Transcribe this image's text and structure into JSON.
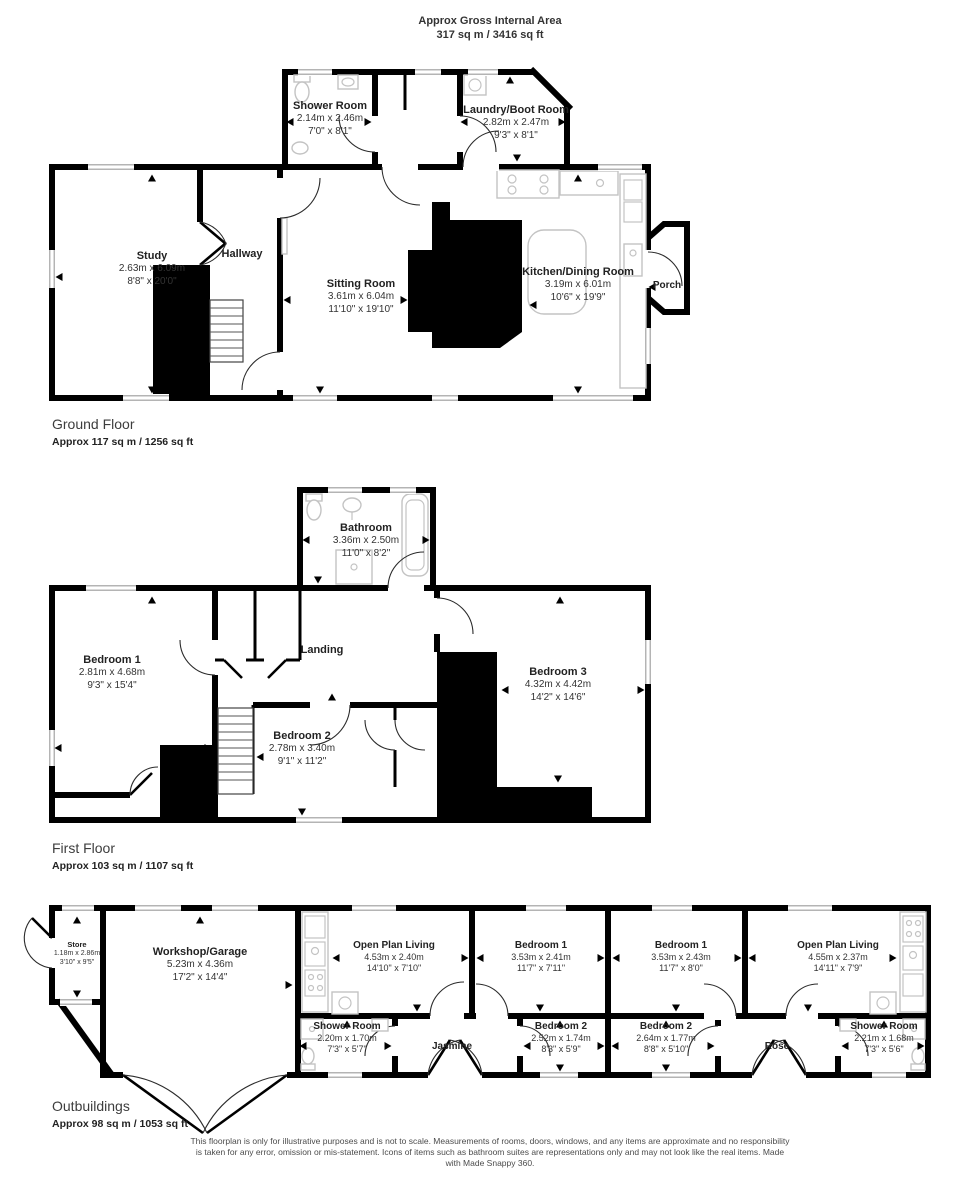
{
  "header": {
    "title": "Approx Gross Internal Area",
    "subtitle": "317 sq m / 3416 sq ft"
  },
  "ground_floor": {
    "title": "Ground Floor",
    "area": "Approx 117 sq m / 1256 sq ft",
    "rooms": {
      "shower_room": {
        "name": "Shower Room",
        "metric": "2.14m x 2.46m",
        "imperial": "7'0\" x 8'1\""
      },
      "laundry_boot_room": {
        "name": "Laundry/Boot Room",
        "metric": "2.82m x 2.47m",
        "imperial": "9'3\" x 8'1\""
      },
      "study": {
        "name": "Study",
        "metric": "2.63m x 6.09m",
        "imperial": "8'8\" x 20'0\""
      },
      "hallway": {
        "name": "Hallway"
      },
      "sitting_room": {
        "name": "Sitting Room",
        "metric": "3.61m x 6.04m",
        "imperial": "11'10\" x 19'10\""
      },
      "kitchen_dining_room": {
        "name": "Kitchen/Dining Room",
        "metric": "3.19m x 6.01m",
        "imperial": "10'6\" x 19'9\""
      },
      "porch": {
        "name": "Porch"
      }
    }
  },
  "first_floor": {
    "title": "First Floor",
    "area": "Approx 103 sq m / 1107 sq ft",
    "rooms": {
      "bathroom": {
        "name": "Bathroom",
        "metric": "3.36m x 2.50m",
        "imperial": "11'0\" x 8'2\""
      },
      "bedroom_1": {
        "name": "Bedroom 1",
        "metric": "2.81m x 4.68m",
        "imperial": "9'3\" x 15'4\""
      },
      "landing": {
        "name": "Landing"
      },
      "bedroom_2": {
        "name": "Bedroom 2",
        "metric": "2.78m x 3.40m",
        "imperial": "9'1\" x 11'2\""
      },
      "bedroom_3": {
        "name": "Bedroom 3",
        "metric": "4.32m x 4.42m",
        "imperial": "14'2\" x 14'6\""
      }
    }
  },
  "outbuildings": {
    "title": "Outbuildings",
    "area": "Approx 98 sq m / 1053 sq ft",
    "rooms": {
      "store": {
        "name": "Store",
        "metric": "1.18m x 2.86m",
        "imperial": "3'10\" x 9'5\""
      },
      "workshop_garage": {
        "name": "Workshop/Garage",
        "metric": "5.23m x 4.36m",
        "imperial": "17'2\" x 14'4\""
      },
      "jasmine_open_plan_living": {
        "name": "Open Plan Living",
        "metric": "4.53m x 2.40m",
        "imperial": "14'10\" x 7'10\""
      },
      "jasmine_bedroom_1": {
        "name": "Bedroom 1",
        "metric": "3.53m x 2.41m",
        "imperial": "11'7\" x 7'11\""
      },
      "jasmine_shower_room": {
        "name": "Shower Room",
        "metric": "2.20m x 1.70m",
        "imperial": "7'3\" x 5'7\""
      },
      "jasmine_bedroom_2": {
        "name": "Bedroom 2",
        "metric": "2.52m x 1.74m",
        "imperial": "8'3\" x 5'9\""
      },
      "jasmine": {
        "name": "Jasmine"
      },
      "rose_bedroom_1": {
        "name": "Bedroom 1",
        "metric": "3.53m x 2.43m",
        "imperial": "11'7\" x 8'0\""
      },
      "rose_open_plan_living": {
        "name": "Open Plan Living",
        "metric": "4.55m x 2.37m",
        "imperial": "14'11\" x 7'9\""
      },
      "rose_bedroom_2": {
        "name": "Bedroom 2",
        "metric": "2.64m x 1.77m",
        "imperial": "8'8\" x 5'10\""
      },
      "rose": {
        "name": "Rose"
      },
      "rose_shower_room": {
        "name": "Shower Room",
        "metric": "2.21m x 1.68m",
        "imperial": "7'3\" x 5'6\""
      }
    }
  },
  "footer": {
    "disclaimer": "This floorplan is only for illustrative purposes and is not to scale. Measurements of rooms, doors, windows, and any items are approximate and no responsibility is taken for any error, omission or mis-statement. Icons of items such as bathroom suites are representations only and may not look like the real items. Made with Made Snappy 360."
  }
}
